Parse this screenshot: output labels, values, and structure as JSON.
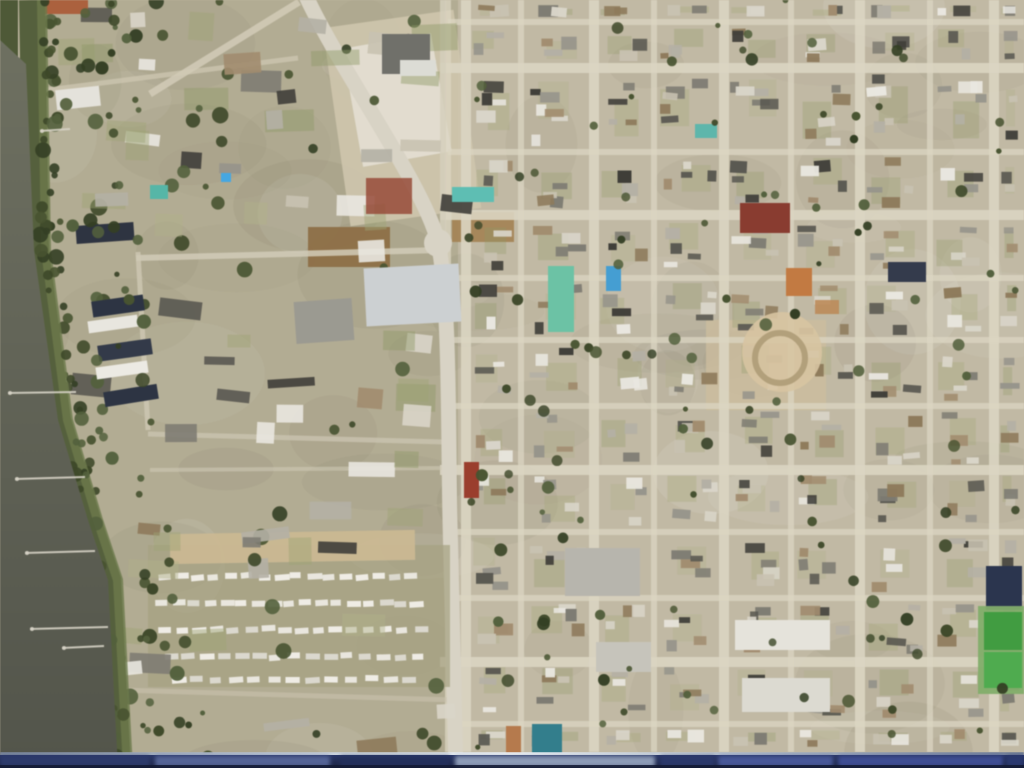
{
  "view": {
    "description": "full-screen aerial satellite imagery of a coastal town with a river on the left, a curving arterial road, a mobile-home park, and a dense residential street grid",
    "visible_text": ""
  },
  "map": {
    "seed": 1337,
    "base_color": "#c2b9a2",
    "left_wash": {
      "x": 28,
      "y": 0,
      "w": 430,
      "h": 768,
      "color": "#a49f80",
      "opacity": 0.5
    },
    "mottle": {
      "count": 70,
      "colors": [
        "#ffffff",
        "#6b6550",
        "#8a8468"
      ]
    },
    "water": {
      "polygon": "0,40 26,64 34,250 58,420 88,520 108,580 118,768 0,768",
      "color_top": "#6e7060",
      "color_bottom": "#53554a",
      "marsh_color": "#55603a",
      "marsh_inner": "#6c7a48",
      "marsh_strip": {
        "x": 0,
        "y": 0,
        "w": 18,
        "h": 262,
        "color": "#4d5934"
      },
      "shoreline": [
        [
          32,
          0
        ],
        [
          36,
          250
        ],
        [
          58,
          420
        ],
        [
          88,
          520
        ],
        [
          108,
          580
        ],
        [
          118,
          768
        ]
      ]
    },
    "docks": {
      "color": "#d6d2c4",
      "lines": [
        [
          70,
          129,
          40,
          131
        ],
        [
          76,
          392,
          8,
          393
        ],
        [
          85,
          477,
          15,
          479
        ],
        [
          95,
          551,
          25,
          553
        ],
        [
          108,
          627,
          30,
          629
        ],
        [
          104,
          646,
          62,
          648
        ]
      ]
    },
    "roads": {
      "main": {
        "path": "M 306,-4 C 340,70 424,185 438,242 C 450,300 448,430 450,520 L 456,772",
        "color": "#d8d3c4",
        "width": 15
      },
      "junction": {
        "cx": 438,
        "cy": 243,
        "r": 14
      },
      "fork": {
        "path": "M 299,2 L 150,94",
        "color": "#d2cab4",
        "width": 7
      },
      "segments": [
        {
          "path": "M 0,96 L 298,58",
          "w": 5,
          "color": "#cdc6ae",
          "op": 0.8
        },
        {
          "path": "M 443,0 L 443,245",
          "w": 6,
          "color": "#d5cfba",
          "op": 0.85
        },
        {
          "path": "M 136,258 L 442,250",
          "w": 6,
          "color": "#d2cbb6",
          "op": 0.85
        },
        {
          "path": "M 138,252 L 148,430",
          "w": 5,
          "color": "#cfc8b2",
          "op": 0.8
        },
        {
          "path": "M 148,434 L 445,442",
          "w": 5,
          "color": "#cfc8b2",
          "op": 0.7
        },
        {
          "path": "M 150,470 L 445,468",
          "w": 4,
          "color": "#cfc8b2",
          "op": 0.6
        },
        {
          "path": "M 120,690 L 455,700",
          "w": 5,
          "color": "#c9c2ac",
          "op": 0.6
        }
      ]
    },
    "grid": {
      "street_color": "#dcd5c0",
      "x_start": 448,
      "x_end": 1024,
      "y_start": 0,
      "y_end": 752,
      "v_major": [
        466,
        594,
        724,
        860,
        994
      ],
      "v_minor": [
        448,
        521,
        654,
        791,
        930
      ],
      "h_major": [
        68,
        215,
        470,
        662
      ],
      "h_minor": [
        22,
        152,
        278,
        340,
        406,
        532,
        598,
        724
      ],
      "w_major": 10,
      "w_minor": 6
    },
    "dirt_lots": [
      {
        "x": 336,
        "y": 18,
        "w": 132,
        "h": 200,
        "color": "#cfc5ab",
        "op": 0.9,
        "rot": -8
      },
      {
        "x": 352,
        "y": 40,
        "w": 90,
        "h": 120,
        "color": "#e4dfd2",
        "op": 0.9,
        "rot": -10
      },
      {
        "x": 308,
        "y": 227,
        "w": 82,
        "h": 40,
        "color": "#8f6f42",
        "op": 0.95,
        "rot": 0
      },
      {
        "x": 452,
        "y": 212,
        "w": 62,
        "h": 30,
        "color": "#a5824f",
        "op": 0.9,
        "rot": 0
      },
      {
        "x": 706,
        "y": 320,
        "w": 120,
        "h": 90,
        "color": "#cdbd9b",
        "op": 0.8,
        "rot": 0
      }
    ],
    "trailer_park": {
      "ground": {
        "x": 148,
        "y": 545,
        "w": 302,
        "h": 142,
        "color": "#a5a17f",
        "op": 0.7
      },
      "bldg_strip": {
        "x": 170,
        "y": 532,
        "w": 245,
        "h": 30,
        "color": "#cbb88f"
      },
      "trailer_colors": [
        "#eceae2",
        "#f2f0e9",
        "#dddbd1"
      ],
      "rows": [
        {
          "y": 575,
          "x1": 158,
          "x2": 420,
          "n": 16,
          "rot": -3
        },
        {
          "y": 602,
          "x1": 155,
          "x2": 425,
          "n": 17,
          "rot": -2
        },
        {
          "y": 628,
          "x1": 158,
          "x2": 430,
          "n": 16,
          "rot": -3
        },
        {
          "y": 655,
          "x1": 162,
          "x2": 428,
          "n": 15,
          "rot": -2
        },
        {
          "y": 678,
          "x1": 170,
          "x2": 420,
          "n": 13,
          "rot": -2
        }
      ]
    },
    "landmarks": [
      {
        "name": "red-roof-building-north",
        "x": 740,
        "y": 203,
        "w": 50,
        "h": 30,
        "color": "#8e3b2e"
      },
      {
        "name": "orange-roof-building",
        "x": 786,
        "y": 268,
        "w": 26,
        "h": 28,
        "color": "#c7793c"
      },
      {
        "name": "orange-roof-annex",
        "x": 815,
        "y": 300,
        "w": 24,
        "h": 14,
        "color": "#c08a55",
        "op": 0.9
      },
      {
        "name": "circular-plaza",
        "shape": "circle",
        "cx": 782,
        "cy": 352,
        "r": 40,
        "color": "#d8c49e",
        "op": 0.9
      },
      {
        "name": "plaza-ring",
        "shape": "ring",
        "cx": 780,
        "cy": 358,
        "r": 25,
        "color": "#b3a078",
        "w": 6
      },
      {
        "name": "pool-long",
        "x": 548,
        "y": 266,
        "w": 26,
        "h": 66,
        "color": "#66c4a4"
      },
      {
        "name": "pool-blue",
        "x": 606,
        "y": 266,
        "w": 15,
        "h": 25,
        "color": "#3f9fd8"
      },
      {
        "name": "pool-teal-1",
        "x": 695,
        "y": 124,
        "w": 22,
        "h": 14,
        "color": "#58b8ac"
      },
      {
        "name": "pool-teal-2",
        "x": 150,
        "y": 185,
        "w": 18,
        "h": 14,
        "color": "#4fb8a8"
      },
      {
        "name": "pool-teal-3",
        "x": 452,
        "y": 187,
        "w": 42,
        "h": 15,
        "color": "#57c0b4"
      },
      {
        "name": "pool-small-blue",
        "x": 221,
        "y": 173,
        "w": 10,
        "h": 9,
        "color": "#3fa8e8"
      },
      {
        "name": "red-building-roadside",
        "x": 464,
        "y": 462,
        "w": 15,
        "h": 36,
        "color": "#a03c2a"
      },
      {
        "name": "red-roof-topleft",
        "x": 40,
        "y": 0,
        "w": 48,
        "h": 14,
        "color": "#b0603a"
      },
      {
        "name": "gray-big-building-top",
        "x": 382,
        "y": 34,
        "w": 48,
        "h": 40,
        "color": "#70706a"
      },
      {
        "name": "gray-big-building-top-white",
        "x": 400,
        "y": 60,
        "w": 36,
        "h": 16,
        "color": "#dcdcd4"
      },
      {
        "name": "big-flat-building",
        "x": 365,
        "y": 266,
        "w": 95,
        "h": 58,
        "color": "#ccd0d2",
        "rot": -3
      },
      {
        "name": "flat-building-2",
        "x": 295,
        "y": 300,
        "w": 58,
        "h": 42,
        "color": "#9b9a90",
        "rot": -4
      },
      {
        "name": "red-square-pool-building",
        "x": 366,
        "y": 178,
        "w": 46,
        "h": 36,
        "color": "#9c4a36",
        "op": 0.85
      },
      {
        "name": "navy-condo-1",
        "x": 92,
        "y": 298,
        "w": 52,
        "h": 16,
        "color": "#2c3444",
        "rot": -8
      },
      {
        "name": "white-condo-1",
        "x": 88,
        "y": 318,
        "w": 50,
        "h": 12,
        "color": "#e8e6de",
        "rot": -8
      },
      {
        "name": "navy-condo-2",
        "x": 98,
        "y": 342,
        "w": 54,
        "h": 16,
        "color": "#323a4a",
        "rot": -8
      },
      {
        "name": "white-condo-2",
        "x": 96,
        "y": 364,
        "w": 52,
        "h": 12,
        "color": "#eceae2",
        "rot": -8
      },
      {
        "name": "navy-condo-3",
        "x": 104,
        "y": 388,
        "w": 54,
        "h": 15,
        "color": "#2c3444",
        "rot": -9
      },
      {
        "name": "navy-apartment-top",
        "x": 76,
        "y": 224,
        "w": 58,
        "h": 18,
        "color": "#2e3442",
        "rot": -4
      },
      {
        "name": "white-pair-topleft",
        "x": 56,
        "y": 88,
        "w": 44,
        "h": 20,
        "color": "#e4e2da",
        "rot": -6
      },
      {
        "name": "gray-big-box-1",
        "x": 565,
        "y": 548,
        "w": 75,
        "h": 48,
        "color": "#b7b5ac"
      },
      {
        "name": "gray-big-box-2",
        "x": 596,
        "y": 642,
        "w": 55,
        "h": 30,
        "color": "#c6c4ba"
      },
      {
        "name": "white-box-row-1",
        "x": 735,
        "y": 620,
        "w": 95,
        "h": 30,
        "color": "#e5e3da"
      },
      {
        "name": "white-box-row-2",
        "x": 742,
        "y": 678,
        "w": 88,
        "h": 34,
        "color": "#dcdad0"
      },
      {
        "name": "navy-big-roof",
        "x": 986,
        "y": 566,
        "w": 36,
        "h": 44,
        "color": "#2a3550"
      },
      {
        "name": "sports-court-surround",
        "x": 978,
        "y": 606,
        "w": 46,
        "h": 88,
        "color": "#7fae66",
        "op": 0.95
      },
      {
        "name": "sports-court-1",
        "x": 984,
        "y": 612,
        "w": 38,
        "h": 38,
        "color": "#3b9e3b"
      },
      {
        "name": "sports-court-2",
        "x": 984,
        "y": 652,
        "w": 38,
        "h": 36,
        "color": "#49ad49"
      },
      {
        "name": "navy-roof-topright",
        "x": 888,
        "y": 262,
        "w": 38,
        "h": 20,
        "color": "#333b4e"
      },
      {
        "name": "teal-building-bottom",
        "x": 532,
        "y": 724,
        "w": 30,
        "h": 30,
        "color": "#2e7f8e"
      },
      {
        "name": "orange-building-bottom",
        "x": 506,
        "y": 726,
        "w": 15,
        "h": 28,
        "color": "#b97948"
      }
    ],
    "palette": {
      "house": [
        "#e9e7df",
        "#d9d5c8",
        "#b4b0a4",
        "#96948a",
        "#7e7c72",
        "#a38c6c",
        "#8f7a58",
        "#595850",
        "#3f3e38",
        "#c9c2b0"
      ],
      "tree": [
        "#3d4827",
        "#47532e",
        "#333f22",
        "#52603a"
      ],
      "lawn": [
        "#9ea470",
        "#8f9864",
        "#b0b184"
      ]
    },
    "procedural": {
      "houses_per_cell_div": 800,
      "left_blobs": 150,
      "left_trees": 80,
      "right_trees": 110,
      "marsh_trees": 60
    }
  },
  "taskbar": {
    "edge_stops": [
      "#7d8aa0",
      "#b9c4d2",
      "#eef2f6",
      "#aab6c6",
      "#6f7c96"
    ],
    "body_top_color": "#2a3768",
    "body_bottom_color": "#1a2240",
    "segments": [
      {
        "x": 0,
        "w": 150,
        "color": "#2e3c6e",
        "op": 0.9
      },
      {
        "x": 155,
        "w": 175,
        "color": "#5a6a9e",
        "op": 0.9
      },
      {
        "x": 340,
        "w": 110,
        "color": "#23305c",
        "op": 0.9
      },
      {
        "x": 455,
        "w": 200,
        "color": "#93a2bd",
        "op": 0.95
      },
      {
        "x": 660,
        "w": 55,
        "color": "#2c3a6e",
        "op": 0.9
      },
      {
        "x": 718,
        "w": 115,
        "color": "#4c5da0",
        "op": 0.9
      },
      {
        "x": 838,
        "w": 165,
        "color": "#41519a",
        "op": 0.9
      },
      {
        "x": 1006,
        "w": 18,
        "color": "#2b3a72",
        "op": 0.95
      }
    ]
  }
}
